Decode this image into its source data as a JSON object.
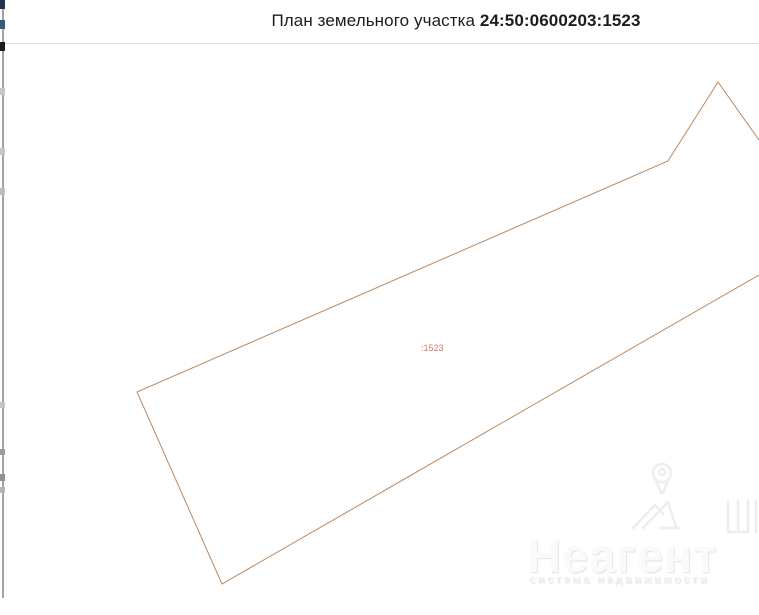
{
  "header": {
    "title_prefix": "План земельного участка",
    "cadastral_number": "24:50:0600203:1523"
  },
  "map": {
    "parcel_label": ":1523",
    "outline_color": "#b98a62",
    "label_color": "#d8736e",
    "points_str": "759,96 718,38 668,117 137,348 222,540 759,231",
    "visible_vertices_note": "polyline open at right image edge"
  },
  "watermark": {
    "brand": "Неагент",
    "tagline": "система недвижимости"
  },
  "colors": {
    "divider": "#dbe2e9",
    "window_edge_line": "#a3a3a3",
    "title_text": "#1c1c1c"
  }
}
